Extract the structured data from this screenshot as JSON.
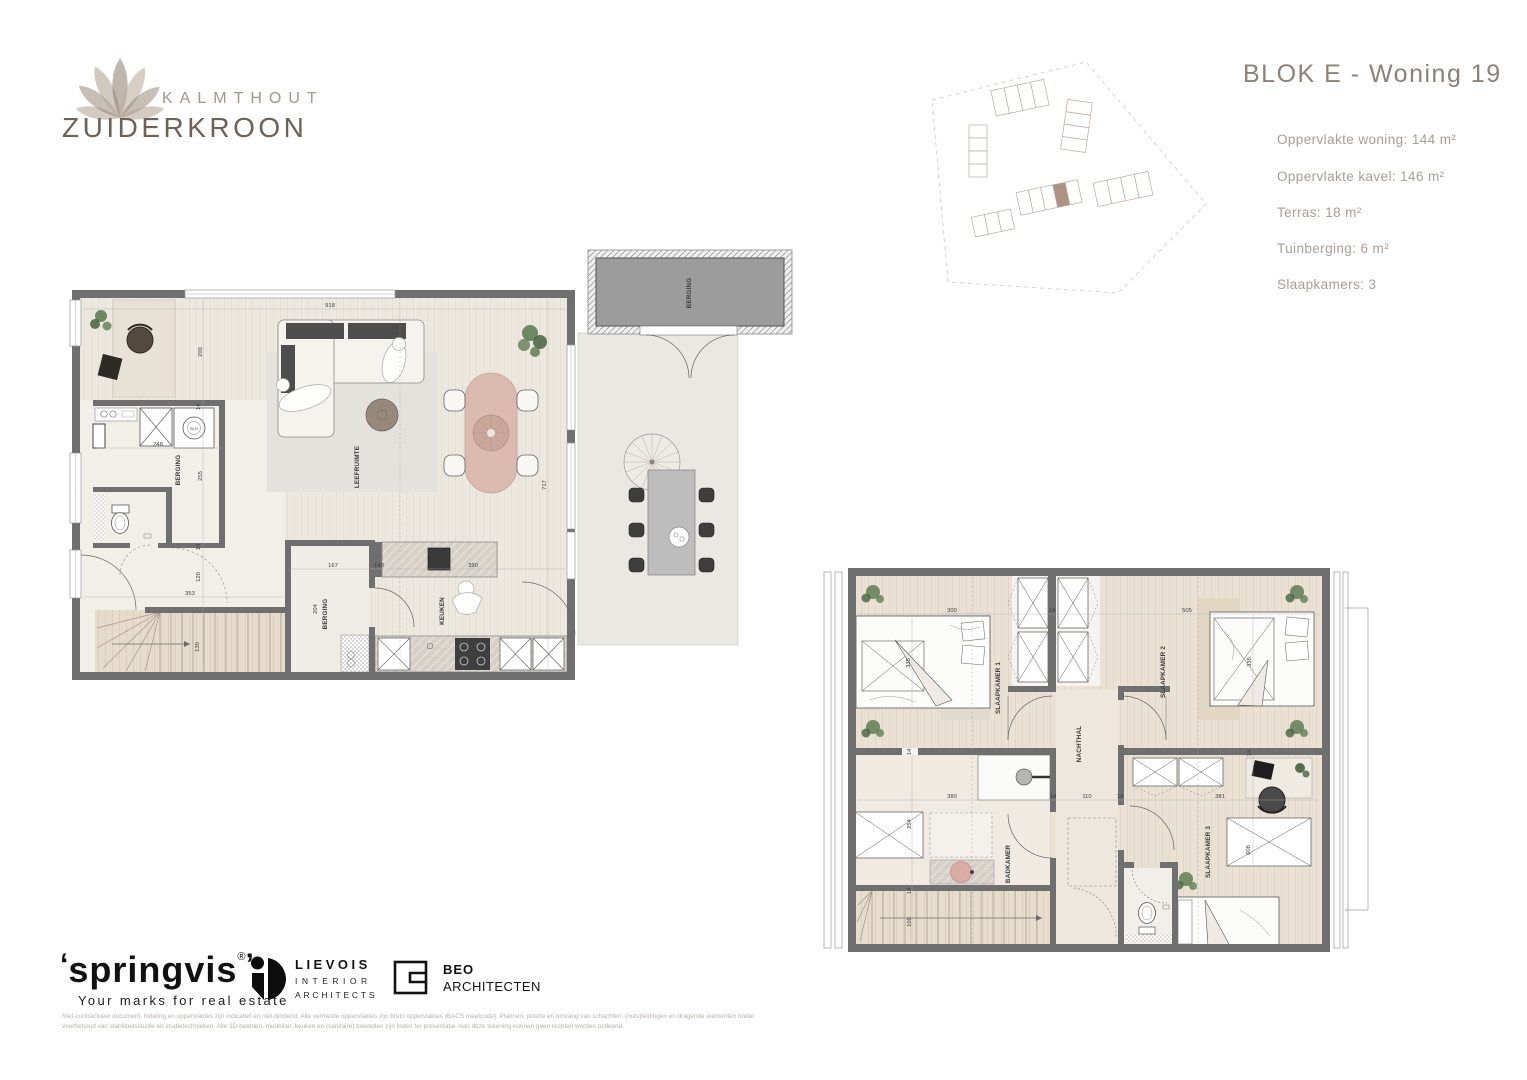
{
  "brand": {
    "kicker": "KALMTHOUT",
    "name": "ZUIDERKROON"
  },
  "unit": {
    "title": "BLOK E - Woning 19",
    "specs": [
      "Oppervlakte woning: 144 m²",
      "Oppervlakte kavel: 146 m²",
      "Terras: 18 m²",
      "Tuinberging: 6 m²",
      "Slaapkamers: 3"
    ]
  },
  "site_plan": {
    "highlight_color": "#AE9384"
  },
  "ground_floor": {
    "labels": {
      "berging_utility": "BERGING",
      "berging_storage": "BERGING",
      "berging_shed": "BERGING",
      "leefruimte": "LEEFRUIMTE",
      "keuken": "KEUKEN",
      "washer": "W-D"
    },
    "dims": {
      "top": "918",
      "left": "200",
      "wall_a": "14",
      "berging_w": "248",
      "berging_h": "255",
      "wall_b": "14",
      "hall_h": "120",
      "hall_w": "353",
      "stairs": "130",
      "storage_h": "204",
      "storage_w": "167",
      "storage_wall": "140",
      "keuken_w": "390",
      "living_h": "717"
    }
  },
  "upper_floor": {
    "labels": {
      "slaapkamer1": "SLAAPKAMER 1",
      "slaapkamer2": "SLAAPKAMER 2",
      "slaapkamer3": "SLAAPKAMER 3",
      "nachthal": "NACHTHAL",
      "badkamer": "BADKAMER"
    },
    "dims": {
      "sk1_w": "300",
      "wall_top": "14",
      "sk2_w": "505",
      "sk1_bed": "335",
      "sk2_bed": "335",
      "wall_mid": "14",
      "badkamer_w": "380",
      "badkamer_h": "254",
      "wall_c": "14",
      "hal_w": "110",
      "wall_d": "14",
      "sk3_w": "381",
      "wall_e": "14",
      "sk3_wardrobe": "608",
      "wall_f": "14",
      "stairs_w": "100"
    }
  },
  "footer": {
    "springvis": {
      "open_quote": "‘",
      "name": "springvis",
      "close_quote": "’",
      "reg": "®",
      "tagline": "Your marks for real estate"
    },
    "lievois": {
      "line1": "LIEVOIS",
      "line2": "INTERIOR",
      "line3": "ARCHITECTS"
    },
    "beo": {
      "line1": "BEO",
      "line2": "ARCHITECTEN"
    },
    "disclaimer": "Niet-contractueel document. Indeling en oppervlaktes zijn indicatief en niet-bindend. Alle vermelde oppervlaktes zijn bruto oppervlaktes (BACS meetcode). Plannen, positie en omvang van schachten, (nuts)leidingen en dragende elementen onder voorbehoud van stabiliteitsstudie en studietechnieken. Alle 3D-beelden, meubilair, keuken en (sanitaire) toestellen zijn louter ter presentatie. Aan deze tekening kunnen geen rechten worden ontleend."
  }
}
